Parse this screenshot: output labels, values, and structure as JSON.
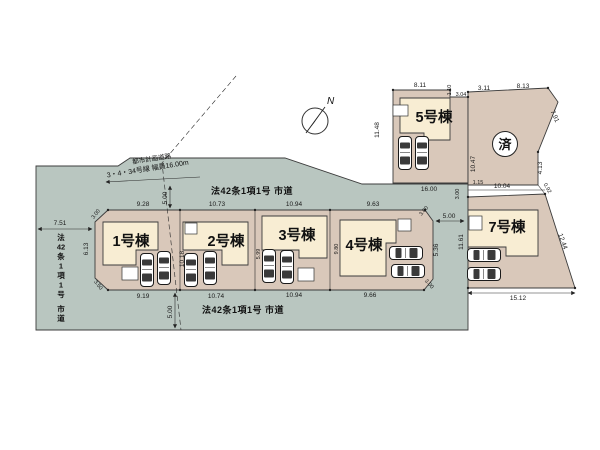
{
  "compass": {
    "label": "N"
  },
  "roads": {
    "top_label": "法42条1項1号 市道",
    "bottom_label": "法42条1項1号 市道",
    "left_label": "法42条1項1号 市道",
    "planned_line1": "都市計画道路",
    "planned_line2": "3・4・34号線 幅員16.00m"
  },
  "lots": [
    {
      "label": "1号棟"
    },
    {
      "label": "2号棟"
    },
    {
      "label": "3号棟"
    },
    {
      "label": "4号棟"
    },
    {
      "label": "5号棟"
    },
    {
      "label": "7号棟"
    },
    {
      "label": "済"
    }
  ],
  "dims": [
    "8.11",
    "1.10",
    "3.04",
    "3.11",
    "8.13",
    "11.48",
    "10.47",
    "16.00",
    "7.91",
    "4.13",
    "0.92",
    "1.15",
    "3.00",
    "10.04",
    "12.44",
    "11.61",
    "5.00",
    "15.12",
    "9.28",
    "10.73",
    "10.94",
    "9.63",
    "3.00",
    "5.36",
    "3.00",
    "9.66",
    "10.94",
    "10.74",
    "9.19",
    "6.13",
    "3.00",
    "3.50",
    "7.51",
    "10.18",
    "5.99",
    "9.80",
    "5.00",
    "5.00"
  ],
  "colors": {
    "road_fill": "#b9c6c0",
    "lot_fill": "#d9c8ba",
    "building_fill": "#f8edd3",
    "line": "#333333"
  }
}
